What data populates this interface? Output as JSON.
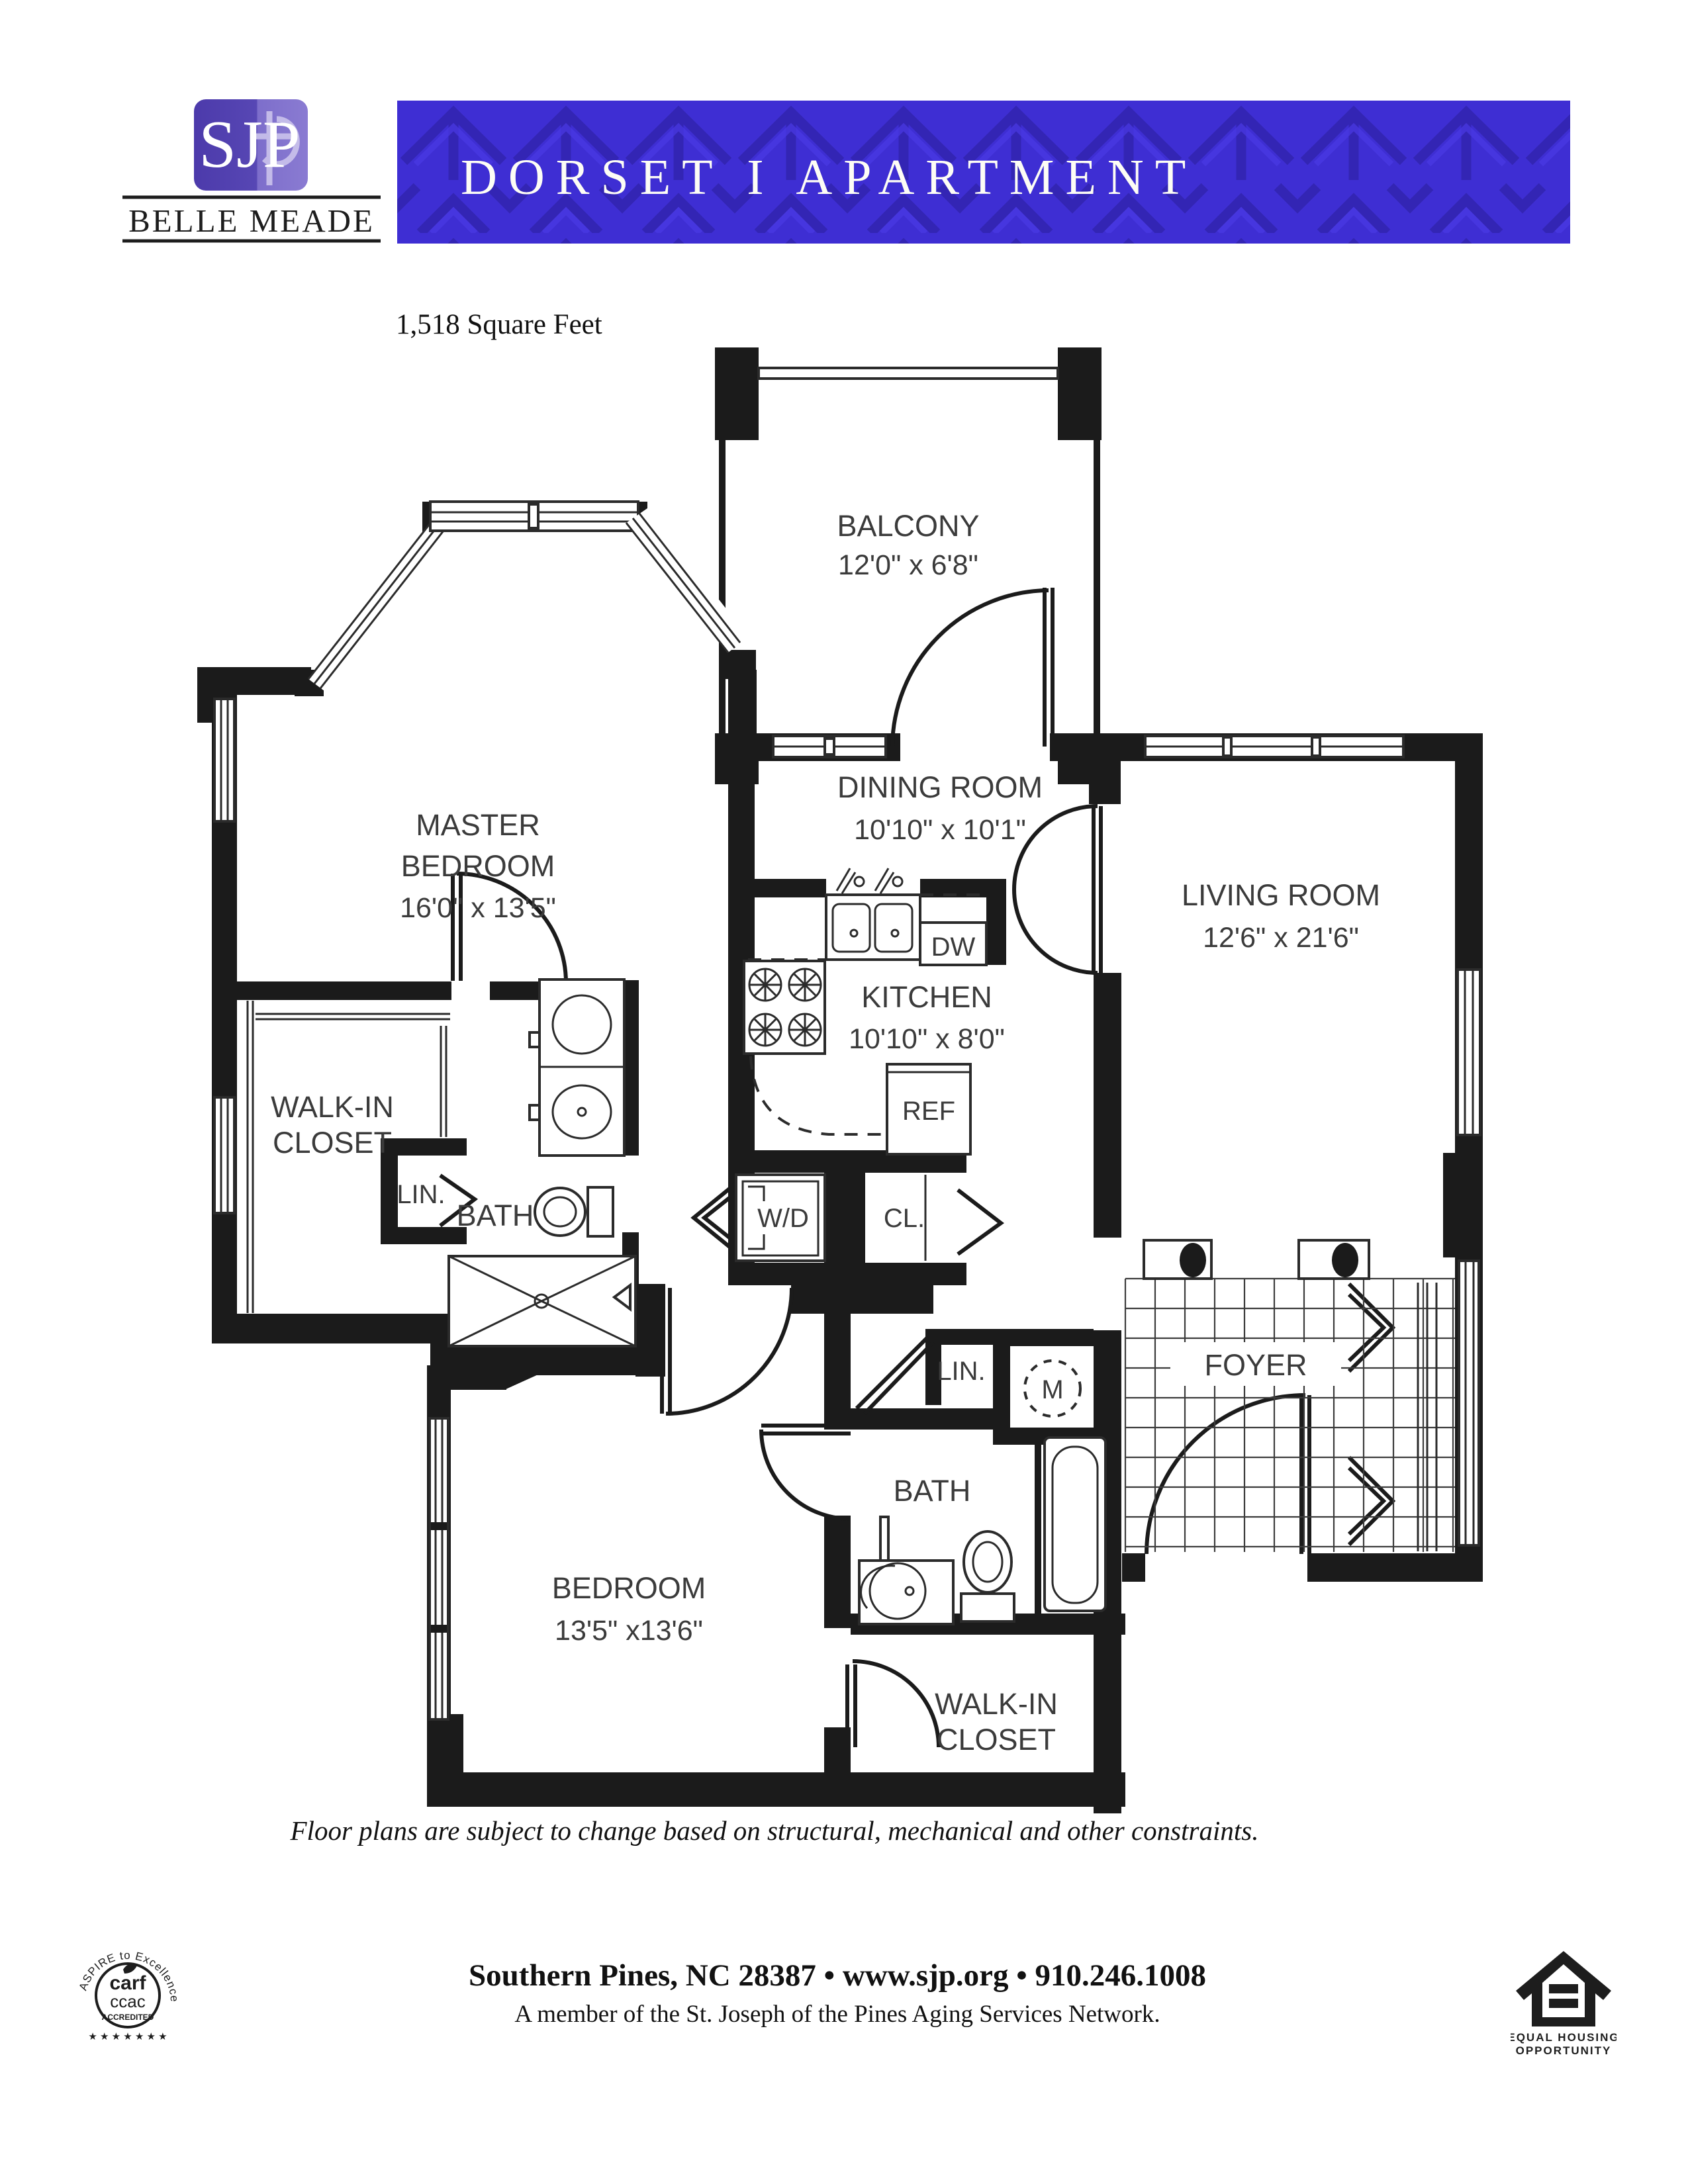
{
  "header": {
    "logo": {
      "monogram": "SJP",
      "brand": "BELLE MEADE"
    },
    "banner_title": "DORSET I APARTMENT"
  },
  "plan": {
    "area_label": "1,518 Square Feet",
    "rooms": {
      "balcony": {
        "name": "BALCONY",
        "dims": "12'0\" x 6'8\""
      },
      "master_bedroom": {
        "line1": "MASTER",
        "line2": "BEDROOM",
        "dims": "16'0\" x 13'5\""
      },
      "dining_room": {
        "name": "DINING ROOM",
        "dims": "10'10\" x 10'1\""
      },
      "living_room": {
        "name": "LIVING ROOM",
        "dims": "12'6\" x 21'6\""
      },
      "kitchen": {
        "name": "KITCHEN",
        "dims": "10'10\" x 8'0\""
      },
      "walk_in_closet_master": {
        "line1": "WALK-IN",
        "line2": "CLOSET"
      },
      "master_bath": {
        "name": "BATH"
      },
      "master_linen": {
        "name": "LIN."
      },
      "washer_dryer": {
        "name": "W/D"
      },
      "hall_closet": {
        "name": "CL."
      },
      "refrigerator": {
        "name": "REF"
      },
      "dishwasher": {
        "name": "DW"
      },
      "foyer": {
        "name": "FOYER"
      },
      "hall_linen": {
        "name": "LIN."
      },
      "mechanical": {
        "name": "M"
      },
      "bath2": {
        "name": "BATH"
      },
      "bedroom2": {
        "name": "BEDROOM",
        "dims": "13'5\" x13'6\""
      },
      "walk_in_closet2": {
        "line1": "WALK-IN",
        "line2": "CLOSET"
      }
    },
    "disclaimer": "Floor plans are subject to change based on structural, mechanical and other constraints."
  },
  "footer": {
    "address_line": "Southern Pines, NC 28387  •  www.sjp.org  •  910.246.1008",
    "network_line": "A member of the St. Joseph of the Pines Aging Services Network.",
    "carf_seal": {
      "arc_text": "ASPIRE to Excellence®",
      "line1": "carf",
      "line2": "ccac",
      "line3": "ACCREDITED",
      "stars": "★ ★ ★ ★ ★ ★ ★"
    },
    "equal_housing": {
      "line1": "EQUAL HOUSING",
      "line2": "OPPORTUNITY"
    }
  },
  "colors": {
    "banner_purple": "#3E2ED3",
    "banner_pattern_dark": "#3325B4",
    "banner_pattern_light": "#4A38E4",
    "logo_purple": "#4C3AAB",
    "logo_purple_light": "#8A7BD2",
    "wall_black": "#1B1B1B"
  }
}
